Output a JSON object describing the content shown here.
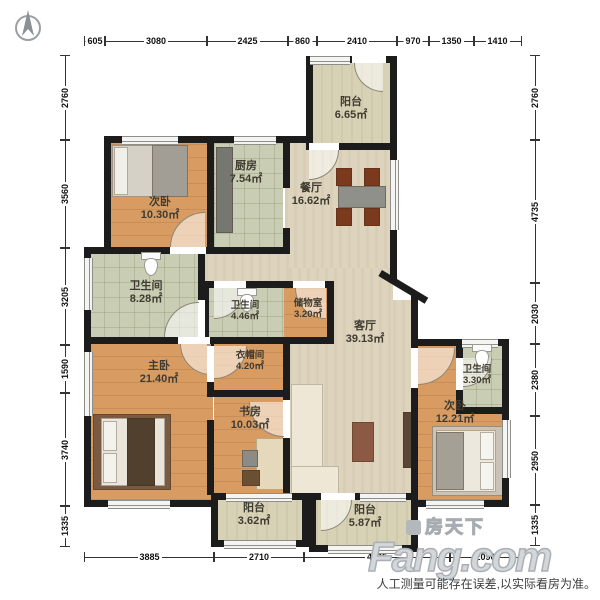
{
  "plan": {
    "rooms": [
      {
        "name": "次卧",
        "area": "10.30㎡"
      },
      {
        "name": "厨房",
        "area": "7.54㎡"
      },
      {
        "name": "餐厅",
        "area": "16.62㎡"
      },
      {
        "name": "阳台",
        "area": "6.65㎡"
      },
      {
        "name": "卫生间",
        "area": "8.28㎡"
      },
      {
        "name": "卫生间",
        "area": "4.46㎡"
      },
      {
        "name": "储物室",
        "area": "3.20㎡"
      },
      {
        "name": "客厅",
        "area": "39.13㎡"
      },
      {
        "name": "主卧",
        "area": "21.40㎡"
      },
      {
        "name": "衣帽间",
        "area": "4.20㎡"
      },
      {
        "name": "书房",
        "area": "10.03㎡"
      },
      {
        "name": "次卧",
        "area": "12.21㎡"
      },
      {
        "name": "卫生间",
        "area": "3.30㎡"
      },
      {
        "name": "阳台",
        "area": "3.62㎡"
      },
      {
        "name": "阳台",
        "area": "5.87㎡"
      }
    ],
    "dims": {
      "top": [
        "605",
        "3080",
        "2425",
        "860",
        "2410",
        "970",
        "1350",
        "1410"
      ],
      "bottom": [
        "3885",
        "2710",
        "4395",
        "2090"
      ],
      "left": [
        "2760",
        "3560",
        "3205",
        "1590",
        "3740",
        "1335"
      ],
      "right": [
        "2760",
        "4735",
        "2030",
        "2380",
        "2950",
        "1335"
      ]
    },
    "watermark": {
      "cn": "房天下",
      "en": "Fang.com"
    },
    "disclaimer": "人工测量可能存在误差,以实际看房为准。",
    "colors": {
      "wall": "#1c1c1c",
      "wood": "#d89c62",
      "tile": "#c9cdb3",
      "stone": "#ded4be",
      "balcony": "#d7d2b6"
    }
  }
}
